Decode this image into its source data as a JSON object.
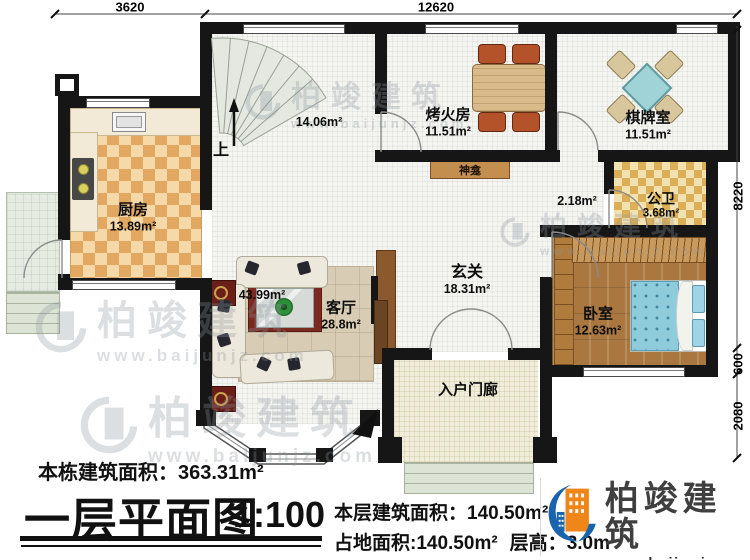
{
  "watermark": {
    "name": "柏竣建筑",
    "url": "www.baijunjz.com"
  },
  "dimensions": {
    "top_left": "3620",
    "top_right": "12620",
    "right_top": "8220",
    "right_mid": "600",
    "right_bottom": "2080"
  },
  "rooms": {
    "stair_area": {
      "area": "14.06m²",
      "up_label": "上"
    },
    "fire_room": {
      "name": "烤火房",
      "area": "11.51m²"
    },
    "chess_room": {
      "name": "棋牌室",
      "area": "11.51m²"
    },
    "shrine": {
      "name": "神龛"
    },
    "kitchen": {
      "name": "厨房",
      "area": "13.89m²"
    },
    "corridor": {
      "area": "2.18m²"
    },
    "bathroom": {
      "name": "公卫",
      "area": "3.68m²"
    },
    "foyer": {
      "name": "玄关",
      "area": "18.31m²"
    },
    "living_room": {
      "name": "客厅",
      "area": "28.8m²",
      "combined_area": "43.99m²"
    },
    "bedroom": {
      "name": "卧室",
      "area": "12.63m²"
    },
    "entry_porch": {
      "name": "入户门廊"
    }
  },
  "title_block": {
    "total_area_label": "本栋建筑面积：",
    "total_area_value": "363.31m²",
    "plan_title": "一层平面图",
    "scale": "1:100",
    "floor_area_label": "本层建筑面积：",
    "floor_area_value": "140.50m²",
    "footprint_label": "占地面积:",
    "footprint_value": "140.50m²",
    "floor_height_label": "层高：",
    "floor_height_value": "3.0m",
    "logo_name": "柏竣建筑",
    "logo_url": "www.baijunjz.com"
  },
  "colors": {
    "wall": "#161616",
    "kitchen_tile": "#e2a761",
    "bath_tile": "#dcae55",
    "wood_floor": "#a9773f",
    "logo_blue": "#1a63ad",
    "logo_orange": "#f08519"
  }
}
